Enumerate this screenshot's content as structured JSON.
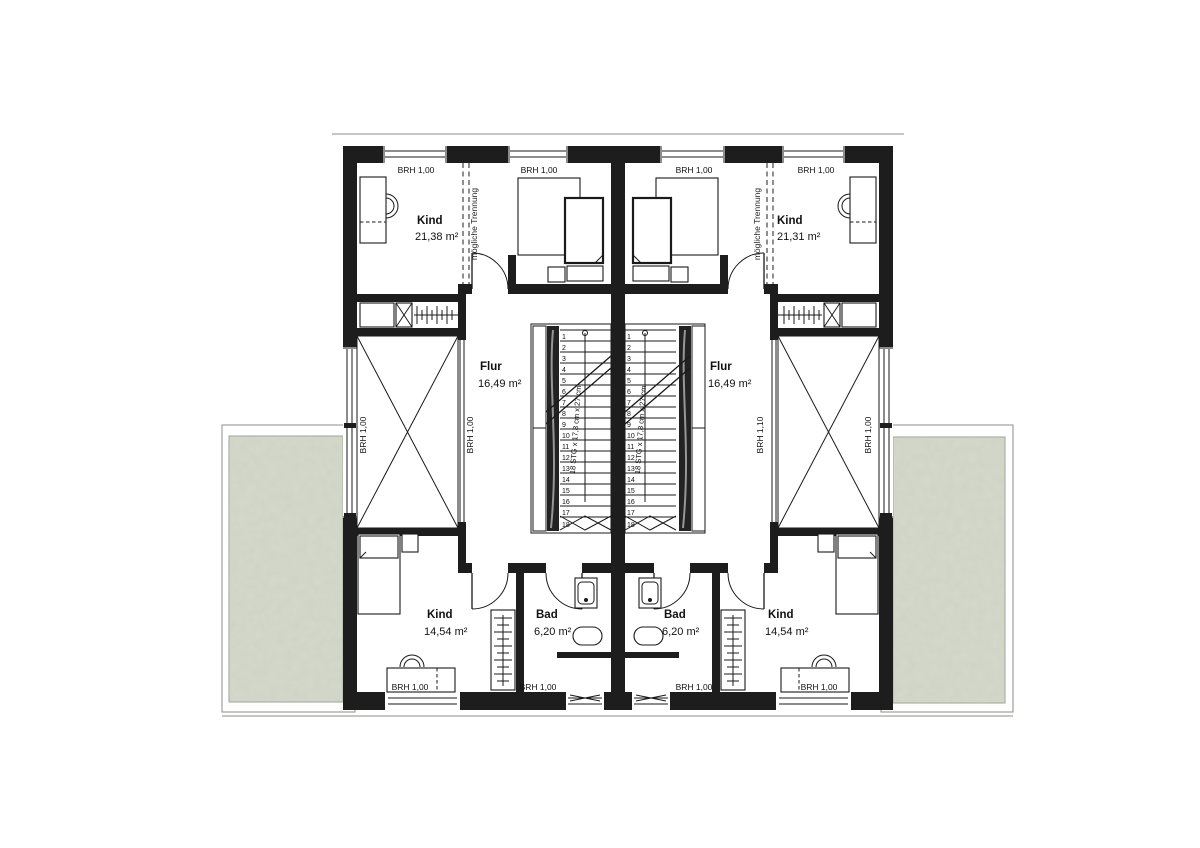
{
  "colors": {
    "wall": "#1d1d1d",
    "line": "#1a1a1a",
    "terrace": "#d4d9ca",
    "terrace_border": "#8a8f84",
    "background": "#ffffff"
  },
  "rooms": {
    "kind_top_left": {
      "name": "Kind",
      "area": "21,38 m²"
    },
    "kind_top_right": {
      "name": "Kind",
      "area": "21,31 m²"
    },
    "kind_bottom_left": {
      "name": "Kind",
      "area": "14,54 m²"
    },
    "kind_bottom_right": {
      "name": "Kind",
      "area": "14,54 m²"
    },
    "flur_left": {
      "name": "Flur",
      "area": "16,49 m²"
    },
    "flur_right": {
      "name": "Flur",
      "area": "16,49 m²"
    },
    "bad_left": {
      "name": "Bad",
      "area": "6,20 m²"
    },
    "bad_right": {
      "name": "Bad",
      "area": "6,20 m²"
    }
  },
  "annotations": {
    "separation_note": "mögliche Trennung",
    "stair_caption": "18 STG x 17,8 cm x 27 cm"
  },
  "parapet_labels": {
    "top": [
      "BRH 1,00",
      "BRH 1,00",
      "BRH 1,00",
      "BRH 1,00"
    ],
    "bottom": [
      "BRH 1,00",
      "BRH 1,00",
      "BRH 1,00",
      "BRH 1,00"
    ],
    "side_left": "BRH 1,00",
    "side_right": "BRH 1,00",
    "void_left": "BRH 1,00",
    "void_right": "BRH 1,10"
  },
  "stairs": {
    "steps": [
      "1",
      "2",
      "3",
      "4",
      "5",
      "6",
      "7",
      "8",
      "9",
      "10",
      "11",
      "12",
      "13",
      "14",
      "15",
      "16",
      "17",
      "18"
    ]
  }
}
